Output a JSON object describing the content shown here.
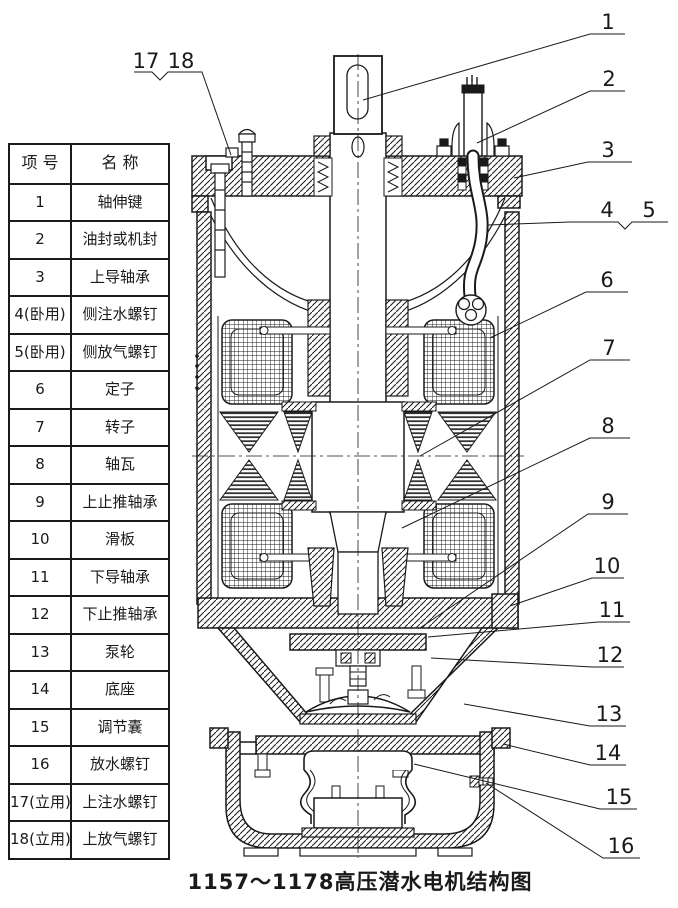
{
  "title": "1157～1178高压潜水电机结构图",
  "table": {
    "headers": [
      "项 号",
      "名 称"
    ],
    "rows": [
      {
        "no": "1",
        "name": "轴伸键"
      },
      {
        "no": "2",
        "name": "油封或机封"
      },
      {
        "no": "3",
        "name": "上导轴承"
      },
      {
        "no": "4(卧用)",
        "name": "侧注水螺钉"
      },
      {
        "no": "5(卧用)",
        "name": "侧放气螺钉"
      },
      {
        "no": "6",
        "name": "定子"
      },
      {
        "no": "7",
        "name": "转子"
      },
      {
        "no": "8",
        "name": "轴瓦"
      },
      {
        "no": "9",
        "name": "上止推轴承"
      },
      {
        "no": "10",
        "name": "滑板"
      },
      {
        "no": "11",
        "name": "下导轴承"
      },
      {
        "no": "12",
        "name": "下止推轴承"
      },
      {
        "no": "13",
        "name": "泵轮"
      },
      {
        "no": "14",
        "name": "底座"
      },
      {
        "no": "15",
        "name": "调节囊"
      },
      {
        "no": "16",
        "name": "放水螺钉"
      },
      {
        "no": "17(立用)",
        "name": "上注水螺钉"
      },
      {
        "no": "18(立用)",
        "name": "上放气螺钉"
      }
    ]
  },
  "callouts": {
    "labels": [
      "1",
      "2",
      "3",
      "4",
      "5",
      "6",
      "7",
      "8",
      "9",
      "10",
      "11",
      "12",
      "13",
      "14",
      "15",
      "16",
      "17",
      "18"
    ]
  },
  "colors": {
    "line": "#1a1a1a",
    "paper": "#ffffff"
  }
}
